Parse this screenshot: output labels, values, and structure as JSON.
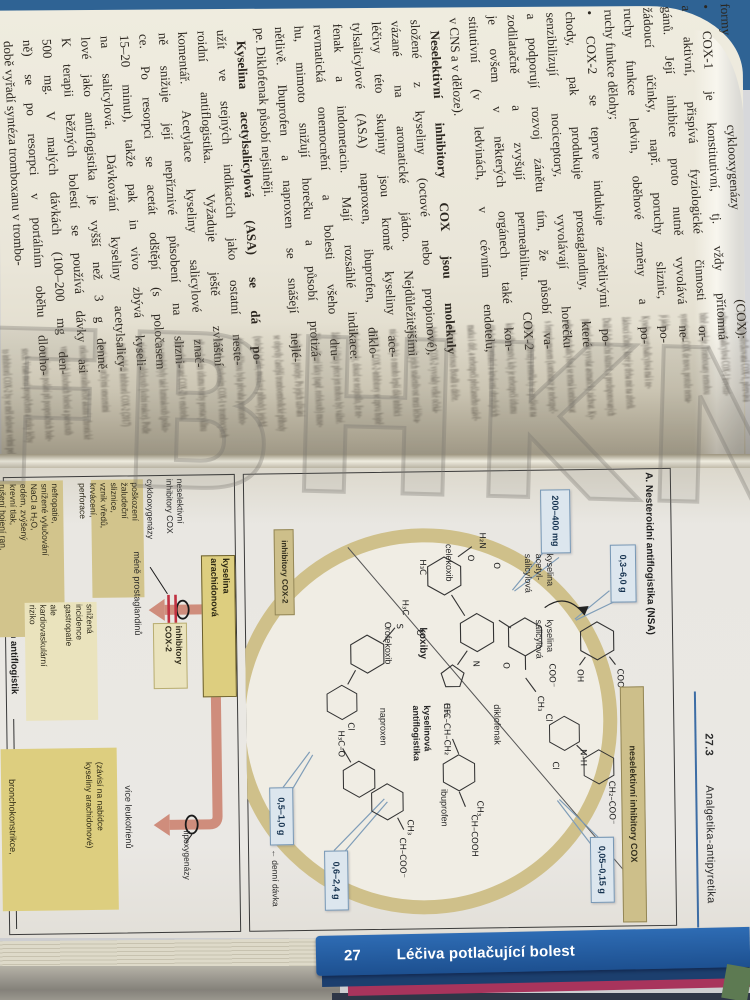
{
  "photo": {
    "watermark": "FBHKNIH"
  },
  "text_page": {
    "lines": [
      "formy cyklooxygenázy (COX):",
      "• COX-1 je konstitutivní, tj. vždy přítomná",
      "a aktivní, přispívá fyziologické činnosti or-",
      "gánů. Její inhibice proto nutně vyvolává ne-",
      "žádoucí účinky, např. poruchy sliznic, po-",
      "ruchy funkce ledvin, oběhové změny a po-",
      "ruchy funkce dělohy;",
      "• COX-2 se teprve indukuje zánětlivými po-",
      "chody, pak produkuje prostaglandiny, které",
      "senzibilizují nociceptory, vyvolávají horečku",
      "a podporují rozvoj zánětu tím, že působí va-",
      "zodilatačně a zvyšují permeabilitu. COX-2",
      "je ovšem v některých orgánech také kon-",
      "stitutivní (v ledvinách, v cévním endotelu,",
      "v CNS a v děloze).",
      "Neselektivní inhibitory COX jsou molekuly",
      "složené z kyseliny (octové nebo propionové),",
      "vázané na aromatické jádro. Nejdůležitějšími",
      "léčivy této skupiny jsou kromě kyseliny ace-",
      "tylsalicylové (ASA) naproxen, ibuprofen, diklo-",
      "fenak a indometacin. Mají rozsáhlé indikace:",
      "revmatická onemocnění a bolesti všeho dru-",
      "hu, mimoto snižují horečku a působí protizá-",
      "nětlivě. Ibuprofen a naproxen se snášejí nejlé-",
      "pe. Diklofenak působí nejsilněji.",
      "Kyselina acetylsalicylová (ASA) se dá po-",
      "užít ve stejných indikacích jako ostatní neste-",
      "roidní antiflogistika. Vyžaduje ještě zvláštní",
      "komentář. Acetylace kyseliny salicylové znač-",
      "ně snižuje její nepříznivé působení na slizni-",
      "ce. Po resorpci se acetát odštěpí (s poločasem",
      "15–20 minut), takže pak in vivo zbývá kyseli-",
      "na salicylová. Dávkování kyseliny acetylsalicy-",
      "lové jako antiflogistika je vyšší než 3 g denně.",
      "K terapii běžných bolestí se používá dávky asi",
      "500 mg. V malých dávkách (100–200 mg den-",
      "ně) se po resorpci v portálním oběhu dlouho-",
      "době vyřadí syntéza tromboxanu v trombo-"
    ],
    "gutter_lines": [
      "cytech, zprostředkovaná COX-1, přetrvává",
      "selina acetylsalicylová COX-1 ireverzi-",
      "bilně acetyluje. Tromboxany nemohou",
      "syntetizovat COX de novo, protože nema-",
      "jí jádro.",
      "Kyselina acetylsalicylová má i ne-",
      "žádoucí účinky, které je třeba mít na zřeteli.",
      "Dráždí žaludeční sliznici, u predisponovaných",
      "pacientů může vyvolat astmatický záchvat. Ky-",
      "selina acetylsalicylová se nemá kombinovat",
      "s fenprokumonem (kombinace je nebezpeč-",
      "nější než aditivní) a neměla by se podávat na",
      "konci těhotenství, kdy je nebezpečí útlumu",
      "děložních kontrakcí a krvácení ohrožujících",
      "matku i dítě, a nebezpečí předčasného uzávě-",
      "ru ductus arteriosus Botalli u dítěte.",
      "Inhibitory COX-2 vyvolaly velké očeká-",
      "vání, protože jejich snášenlivost mezi léčiva-",
      "nicí měla být o mnoho lepší díky inhibici",
      "ze COX-2. COX-2-inhibitory se zprvu hojně",
      "předepisovaly, dokud se nezjistilo, že ne-",
      "žádoucí účinky přece jen mohou být vážné.",
      "Tak se některé látky (např. rofekoxib) muse-",
      "ly stáhnout z prodeje. Po jejich užívání",
      "se objevily častější tromboembolické příhody",
      "(srdeční infarkt, mozkové příhody), jejichž",
      "dobrou příčinou byla převaha protrombo-",
      "boxanu A₂, působením COX-1 v trombocytech",
      "při současném útlumu tvorby prostacyklinu",
      "(zprostředkované COX-2) v endotelu.",
      "ny v prodeji byly také lumirakoxib (poško-",
      "ní jater) a valdekoxib (kožní reakce). Podle",
      "pozic ještě tří inhibitorů COX-2 (2017)",
      "nosti jsou s určitými omezeními",
      "orikoxib k perorální léčbě akutní i chronické",
      "vmatických kloubních bolestí a parekoxib",
      "travenóznímu podání při pooperačních bole-",
      "stech. Vztah mezi prospěchem a riziky léčby",
      "to inhibitorů COX-2 by se měl sledovat velmi pečlivě."
    ]
  },
  "plate": {
    "section_number": "27.3",
    "section_title": "Analgetika-antipyretika",
    "panel_a": {
      "title": "A. Nesteroidní antiflogistika (NSA)",
      "ring_label": "neselektivní inhibitory COX",
      "cox2_box": "inhibitory COX-2",
      "koxiby": "koxiby",
      "celekoxib": "celekoxib",
      "rofekoxib": "rofekoxib",
      "kys_acetylsalicylova": [
        "kyselina",
        "acetyl-",
        "salicylová"
      ],
      "kys_salicylova": [
        "kyselina",
        "salicylová"
      ],
      "diklofenak": "diklofenak",
      "kyselinova_antiflogistika": [
        "kyselinová",
        "antiflogistika"
      ],
      "ibuprofen": "ibuprofen",
      "naproxen": "naproxen",
      "dose_celekoxib": "200–400 mg",
      "dose_asa": "0,3–6,0 g",
      "dose_diklofenak": "0,05–0,15 g",
      "dose_naproxen": "0,5–1,0 g",
      "dose_ibuprofen": "0,6–2,4 g",
      "denni_davka": "← denní dávka",
      "formulas": [
        "H₂N",
        "O",
        "O",
        "H₃C",
        "CF₃",
        "N",
        "H₃C",
        "S",
        "O",
        "O",
        "Cl",
        "COO⁻",
        "O",
        "CH₃",
        "OH",
        "COO⁻",
        "Cl",
        "Cl",
        "N–H",
        "CH₂–COO⁻",
        "H₃C–CH–CH₂",
        "CH₃",
        "CH–COOH",
        "H₃C–O",
        "CH₃",
        "CH–COO⁻"
      ]
    },
    "panel_b": {
      "title": "B. Nežádoucí účinky nesteroidních antiflogistik",
      "cyklooxygenazy": "cyklooxygenázy",
      "neselektivni": [
        "neselektivní",
        "inhibitory COX"
      ],
      "mene_prostaglandinu": "méně prostaglandinů",
      "inhibitory_cox2": [
        "inhibitory",
        "COX-2"
      ],
      "kyselina_arachidonova": [
        "kyselina",
        "arachidonová"
      ],
      "lipoxygenazy": "lipoxygenázy",
      "vice_leukotrienu": "více leukotrienů",
      "zavisi": [
        "(závisí na nabídce",
        "kyseliny arachidonové)"
      ],
      "bronchokonstrikce": "bronchokonstrikce,",
      "box_gastro": [
        "poškození",
        "žaludeční",
        "sliznice,",
        "vznik vředů,",
        "krvácení,",
        "perforace"
      ],
      "box_nefro": [
        "nefropatie,",
        "snížené vylučování",
        "NaCl a H₂O,",
        "edém, zvýšený",
        "krevní tlak,",
        "rušení hojení ran,",
        "porušená motilita,",
        "průjem"
      ],
      "box_cv1": [
        "snížená",
        "incidence",
        "gastropatie"
      ],
      "box_cv2": [
        "ale",
        "kardiovaskulární",
        "riziko"
      ]
    }
  },
  "footer": {
    "chapter_number": "27",
    "chapter_title": "Léčiva potlačující bolest"
  },
  "colors": {
    "accent_blue": "#2f6394",
    "footer_blue": "#1f5ea9",
    "tan": "#cdbf8a",
    "yellow": "#ddce7f",
    "salmon": "#cf8d7c",
    "crimson": "#a8345c",
    "dose_box": "#dce6ee"
  }
}
